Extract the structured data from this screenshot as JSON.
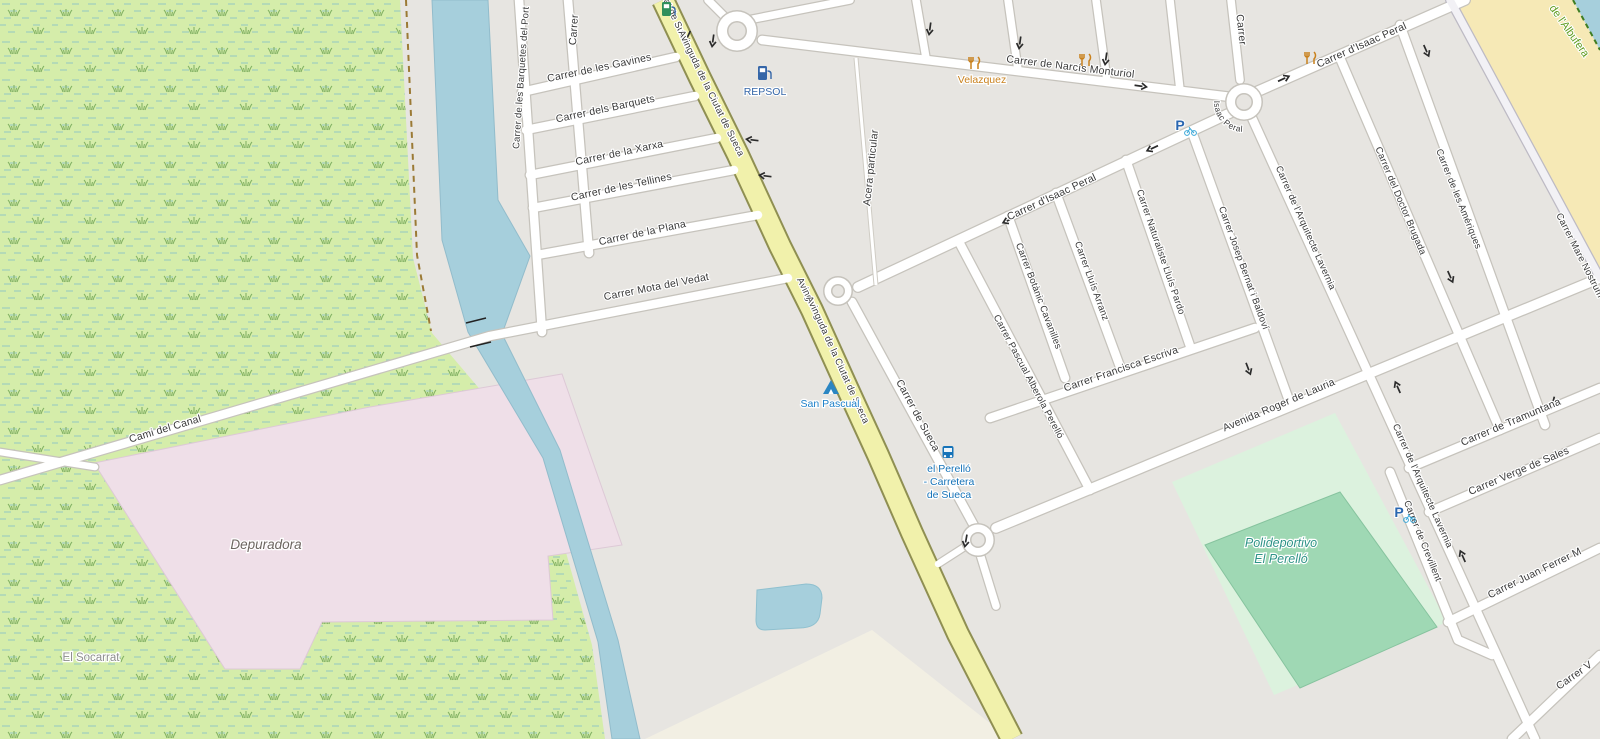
{
  "map": {
    "type": "openstreetmap-rendered-tile",
    "location": "el Perelló, Sueca, Valencia",
    "colors": {
      "urban": "#e7e5e1",
      "wetland": "#d5edaa",
      "water": "#a6cfdc",
      "sand": "#f6e9b6",
      "industrial_pink": "#efdfe8",
      "farmland_beige": "#f2efe3",
      "leisure_green": "#dcf2de",
      "pitch_green": "#9fd8b4",
      "road_fill": "#ffffff",
      "road_casing": "#c6c3bc",
      "avenue_fill": "#f1f1ab",
      "avenue_casing": "#8f8f52",
      "street_label": "#3a3a3a",
      "poi_blue": "#3566a8",
      "poi_orange": "#c9811d",
      "tourism_blue": "#1d80c9",
      "leisure_teal": "#2f9488",
      "nature_green": "#5f9c1e"
    },
    "streets": {
      "barquetes_del_port": "Carrer de les Barquetes del Port",
      "carrer_partial": "Carrer",
      "gavines": "Carrer de les Gavines",
      "barquets": "Carrer dels Barquets",
      "xarxa": "Carrer de la Xarxa",
      "tellines": "Carrer de les Tellines",
      "plana": "Carrer de la Plana",
      "mota_del_vedat": "Carrer Mota del Vedat",
      "cami_del_canal": "Cami del Canal",
      "avinguda": "Avinguda de la Ciutat de Sueca",
      "avinguda_partial_top": "a de la Ciutat de Sueca",
      "avinguda_partial_mid": "Avingu",
      "acera": "Acera particular",
      "narcis_monturiol": "Carrer de Narcís Monturiol",
      "isaac_peral": "Carrer d'Isaac Peral",
      "sueca": "Carrer de Sueca",
      "pascual_alberola": "Carrer Pascual Alberola Perelló",
      "botanic": "Carrer Botànic Cavanilles",
      "lluis_arranz": "Carrer Lluís Arranz",
      "naturaliste": "Carrer Naturaliste Lluís Pardo",
      "josep_bernat": "Carrer Josep Bernat i Baldoví",
      "francisca_escriva": "Carrer Francisca Escriva",
      "roger_de_lauria": "Avenida Roger de Lauria",
      "arquitecte_lavernia": "Carrer de l'Arquitecte Lavernia",
      "doctor_brugada": "Carrer del Doctor Brugada",
      "ameriques": "Carrer de les Amériques",
      "mare_nostrum": "Carrer Mare Nostrum",
      "tramuntana": "Carrer de Tramuntana",
      "verge_de_sales": "Carrer Verge de Sales",
      "juan_ferrer": "Carrer Juan Ferrer M",
      "crevillent": "Carrer de Crevillent",
      "carrer_v_partial": "Carrer V"
    },
    "places": {
      "depuradora": "Depuradora",
      "el_socarrat": "El Socarrat",
      "polideportivo_1": "Polideportivo",
      "polideportivo_2": "El Perelló",
      "albufera": "de l'Albufera"
    },
    "pois": {
      "repsol": "REPSOL",
      "velazquez": "Velazquez",
      "san_pascual": "San Pascual",
      "bus_stop_1": "el Perelló",
      "bus_stop_2": "- Carretera",
      "bus_stop_3": "de Sueca",
      "parking_letter": "P"
    }
  }
}
